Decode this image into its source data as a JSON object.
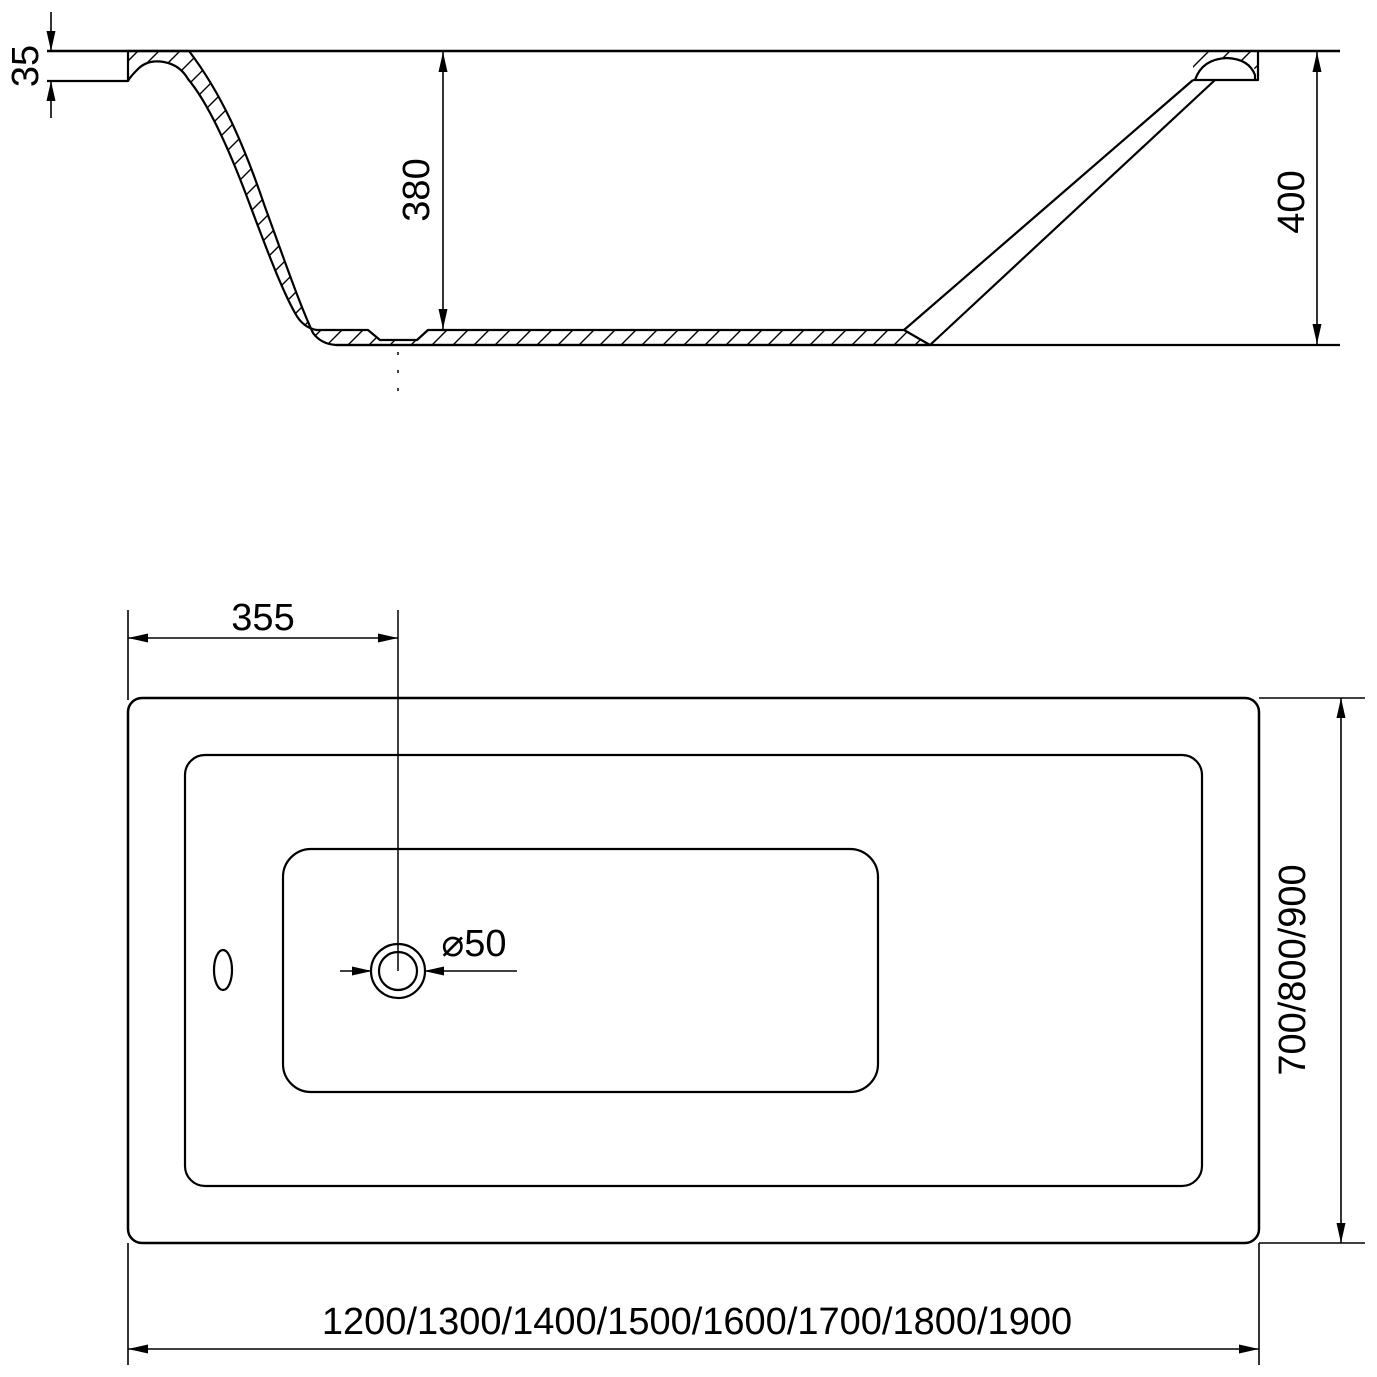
{
  "colors": {
    "background": "#ffffff",
    "line": "#000000",
    "text": "#000000"
  },
  "section_view": {
    "rim_thickness": "35",
    "inner_depth": "380",
    "total_height": "400"
  },
  "plan_view": {
    "drain_offset": "355",
    "drain_diameter": "⌀50",
    "width_options": "700/800/900",
    "length_options": "1200/1300/1400/1500/1600/1700/1800/1900"
  }
}
